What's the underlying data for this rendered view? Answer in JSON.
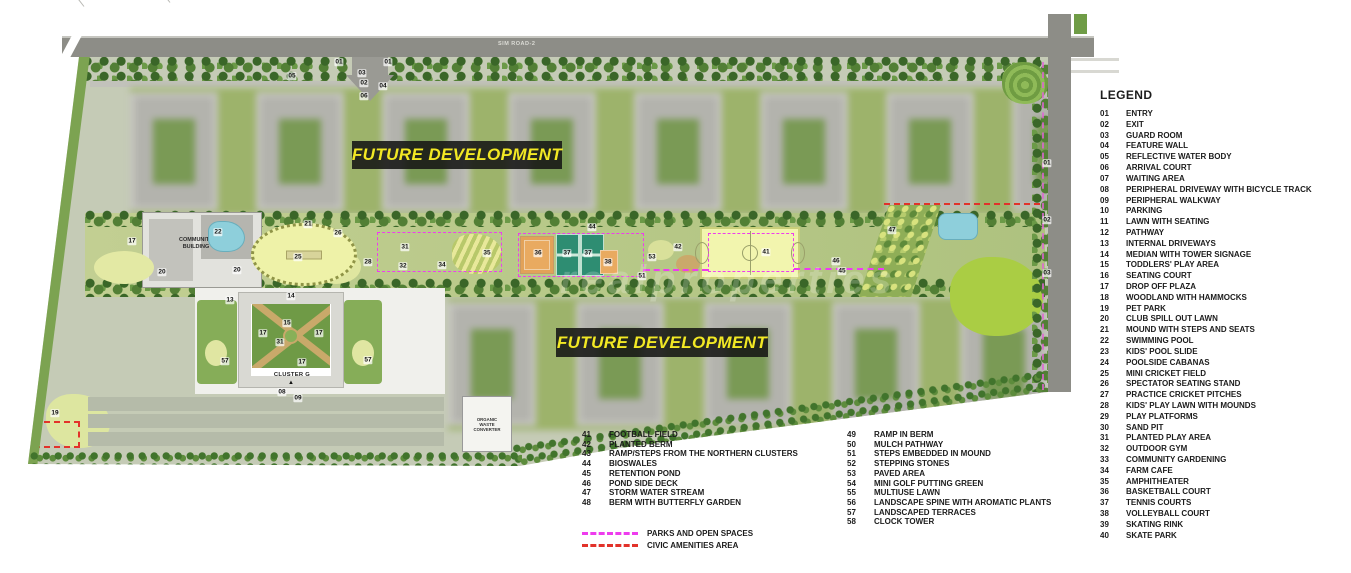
{
  "map": {
    "road_label": "SIM ROAD-2",
    "future_development_label": "FUTURE DEVELOPMENT",
    "community_building_label": "COMMUNITY BUILDING",
    "cluster_label": "CLUSTER G",
    "organic_waste_label": "ORGANIC WASTE CONVERTER",
    "watermark": "realproperties",
    "markers": [
      {
        "num": "01",
        "x": 339,
        "y": 62
      },
      {
        "num": "01",
        "x": 388,
        "y": 62
      },
      {
        "num": "03",
        "x": 362,
        "y": 73
      },
      {
        "num": "02",
        "x": 364,
        "y": 83
      },
      {
        "num": "04",
        "x": 383,
        "y": 86
      },
      {
        "num": "06",
        "x": 364,
        "y": 96
      },
      {
        "num": "05",
        "x": 292,
        "y": 76
      },
      {
        "num": "01",
        "x": 1047,
        "y": 163
      },
      {
        "num": "02",
        "x": 1047,
        "y": 220
      },
      {
        "num": "03",
        "x": 1047,
        "y": 273
      },
      {
        "num": "17",
        "x": 132,
        "y": 241
      },
      {
        "num": "20",
        "x": 162,
        "y": 272
      },
      {
        "num": "22",
        "x": 218,
        "y": 232
      },
      {
        "num": "20",
        "x": 237,
        "y": 270
      },
      {
        "num": "21",
        "x": 308,
        "y": 224
      },
      {
        "num": "25",
        "x": 298,
        "y": 257
      },
      {
        "num": "26",
        "x": 338,
        "y": 233
      },
      {
        "num": "28",
        "x": 368,
        "y": 262
      },
      {
        "num": "31",
        "x": 405,
        "y": 247
      },
      {
        "num": "32",
        "x": 403,
        "y": 266
      },
      {
        "num": "34",
        "x": 442,
        "y": 265
      },
      {
        "num": "35",
        "x": 487,
        "y": 253
      },
      {
        "num": "44",
        "x": 592,
        "y": 227
      },
      {
        "num": "36",
        "x": 538,
        "y": 253
      },
      {
        "num": "37",
        "x": 567,
        "y": 253
      },
      {
        "num": "37",
        "x": 588,
        "y": 253
      },
      {
        "num": "38",
        "x": 608,
        "y": 262
      },
      {
        "num": "53",
        "x": 652,
        "y": 257
      },
      {
        "num": "42",
        "x": 678,
        "y": 247
      },
      {
        "num": "51",
        "x": 642,
        "y": 276
      },
      {
        "num": "41",
        "x": 766,
        "y": 252
      },
      {
        "num": "46",
        "x": 836,
        "y": 261
      },
      {
        "num": "45",
        "x": 842,
        "y": 271
      },
      {
        "num": "47",
        "x": 892,
        "y": 230
      },
      {
        "num": "13",
        "x": 230,
        "y": 300
      },
      {
        "num": "14",
        "x": 291,
        "y": 296
      },
      {
        "num": "15",
        "x": 287,
        "y": 323
      },
      {
        "num": "17",
        "x": 263,
        "y": 333
      },
      {
        "num": "17",
        "x": 319,
        "y": 333
      },
      {
        "num": "31",
        "x": 280,
        "y": 342
      },
      {
        "num": "17",
        "x": 302,
        "y": 362
      },
      {
        "num": "57",
        "x": 225,
        "y": 361
      },
      {
        "num": "57",
        "x": 368,
        "y": 360
      },
      {
        "num": "08",
        "x": 282,
        "y": 392
      },
      {
        "num": "09",
        "x": 298,
        "y": 398
      },
      {
        "num": "19",
        "x": 55,
        "y": 413
      }
    ]
  },
  "legend": {
    "title": "LEGEND",
    "items": [
      {
        "num": "01",
        "label": "ENTRY"
      },
      {
        "num": "02",
        "label": "EXIT"
      },
      {
        "num": "03",
        "label": "GUARD ROOM"
      },
      {
        "num": "04",
        "label": "FEATURE WALL"
      },
      {
        "num": "05",
        "label": "REFLECTIVE WATER BODY"
      },
      {
        "num": "06",
        "label": "ARRIVAL COURT"
      },
      {
        "num": "07",
        "label": "WAITING AREA"
      },
      {
        "num": "08",
        "label": "PERIPHERAL DRIVEWAY WITH BICYCLE TRACK"
      },
      {
        "num": "09",
        "label": "PERIPHERAL WALKWAY"
      },
      {
        "num": "10",
        "label": "PARKING"
      },
      {
        "num": "11",
        "label": "LAWN WITH SEATING"
      },
      {
        "num": "12",
        "label": "PATHWAY"
      },
      {
        "num": "13",
        "label": "INTERNAL DRIVEWAYS"
      },
      {
        "num": "14",
        "label": "MEDIAN WITH TOWER SIGNAGE"
      },
      {
        "num": "15",
        "label": "TODDLERS' PLAY AREA"
      },
      {
        "num": "16",
        "label": "SEATING COURT"
      },
      {
        "num": "17",
        "label": "DROP OFF PLAZA"
      },
      {
        "num": "18",
        "label": "WOODLAND WITH HAMMOCKS"
      },
      {
        "num": "19",
        "label": "PET PARK"
      },
      {
        "num": "20",
        "label": "CLUB SPILL OUT LAWN"
      },
      {
        "num": "21",
        "label": "MOUND WITH STEPS AND SEATS"
      },
      {
        "num": "22",
        "label": "SWIMMING POOL"
      },
      {
        "num": "23",
        "label": "KIDS' POOL SLIDE"
      },
      {
        "num": "24",
        "label": "POOLSIDE CABANAS"
      },
      {
        "num": "25",
        "label": "MINI CRICKET FIELD"
      },
      {
        "num": "26",
        "label": "SPECTATOR SEATING STAND"
      },
      {
        "num": "27",
        "label": "PRACTICE CRICKET PITCHES"
      },
      {
        "num": "28",
        "label": "KIDS' PLAY LAWN WITH MOUNDS"
      },
      {
        "num": "29",
        "label": "PLAY PLATFORMS"
      },
      {
        "num": "30",
        "label": "SAND PIT"
      },
      {
        "num": "31",
        "label": "PLANTED PLAY AREA"
      },
      {
        "num": "32",
        "label": "OUTDOOR GYM"
      },
      {
        "num": "33",
        "label": "COMMUNITY GARDENING"
      },
      {
        "num": "34",
        "label": "FARM CAFE"
      },
      {
        "num": "35",
        "label": "AMPHITHEATER"
      },
      {
        "num": "36",
        "label": "BASKETBALL COURT"
      },
      {
        "num": "37",
        "label": "TENNIS COURTS"
      },
      {
        "num": "38",
        "label": "VOLLEYBALL COURT"
      },
      {
        "num": "39",
        "label": "SKATING RINK"
      },
      {
        "num": "40",
        "label": "SKATE PARK"
      }
    ]
  },
  "facility_legend": {
    "col_a": [
      {
        "num": "41",
        "label": "FOOTBALL FIELD"
      },
      {
        "num": "42",
        "label": "PLANTED BERM"
      },
      {
        "num": "43",
        "label": "RAMP/STEPS FROM THE NORTHERN CLUSTERS"
      },
      {
        "num": "44",
        "label": "BIOSWALES"
      },
      {
        "num": "45",
        "label": "RETENTION POND"
      },
      {
        "num": "46",
        "label": "POND SIDE DECK"
      },
      {
        "num": "47",
        "label": "STORM WATER STREAM"
      },
      {
        "num": "48",
        "label": "BERM WITH BUTTERFLY GARDEN"
      }
    ],
    "col_b": [
      {
        "num": "49",
        "label": "RAMP IN BERM"
      },
      {
        "num": "50",
        "label": "MULCH PATHWAY"
      },
      {
        "num": "51",
        "label": "STEPS EMBEDDED IN MOUND"
      },
      {
        "num": "52",
        "label": "STEPPING STONES"
      },
      {
        "num": "53",
        "label": "PAVED AREA"
      },
      {
        "num": "54",
        "label": "MINI GOLF PUTTING GREEN"
      },
      {
        "num": "55",
        "label": "MULTIUSE LAWN"
      },
      {
        "num": "56",
        "label": "LANDSCAPE SPINE WITH AROMATIC PLANTS"
      },
      {
        "num": "57",
        "label": "LANDSCAPED TERRACES"
      },
      {
        "num": "58",
        "label": "CLOCK TOWER"
      }
    ]
  },
  "area_legend": {
    "parks": {
      "label": "PARKS AND OPEN SPACES",
      "color": "#ee3cee"
    },
    "civic": {
      "label": "CIVIC AMENITIES AREA",
      "color": "#e2322a"
    }
  },
  "colors": {
    "future_dev_text": "#f2e824",
    "future_dev_bg": "#161614",
    "parks_dash": "#ee3cee",
    "civic_dash": "#e2322a",
    "road_gray": "#8d8d87",
    "field_yellow": "#f2f5ae",
    "tennis_green": "#2e8d72",
    "court_orange": "#e9aa60",
    "pool_blue": "#8ecfdb"
  }
}
